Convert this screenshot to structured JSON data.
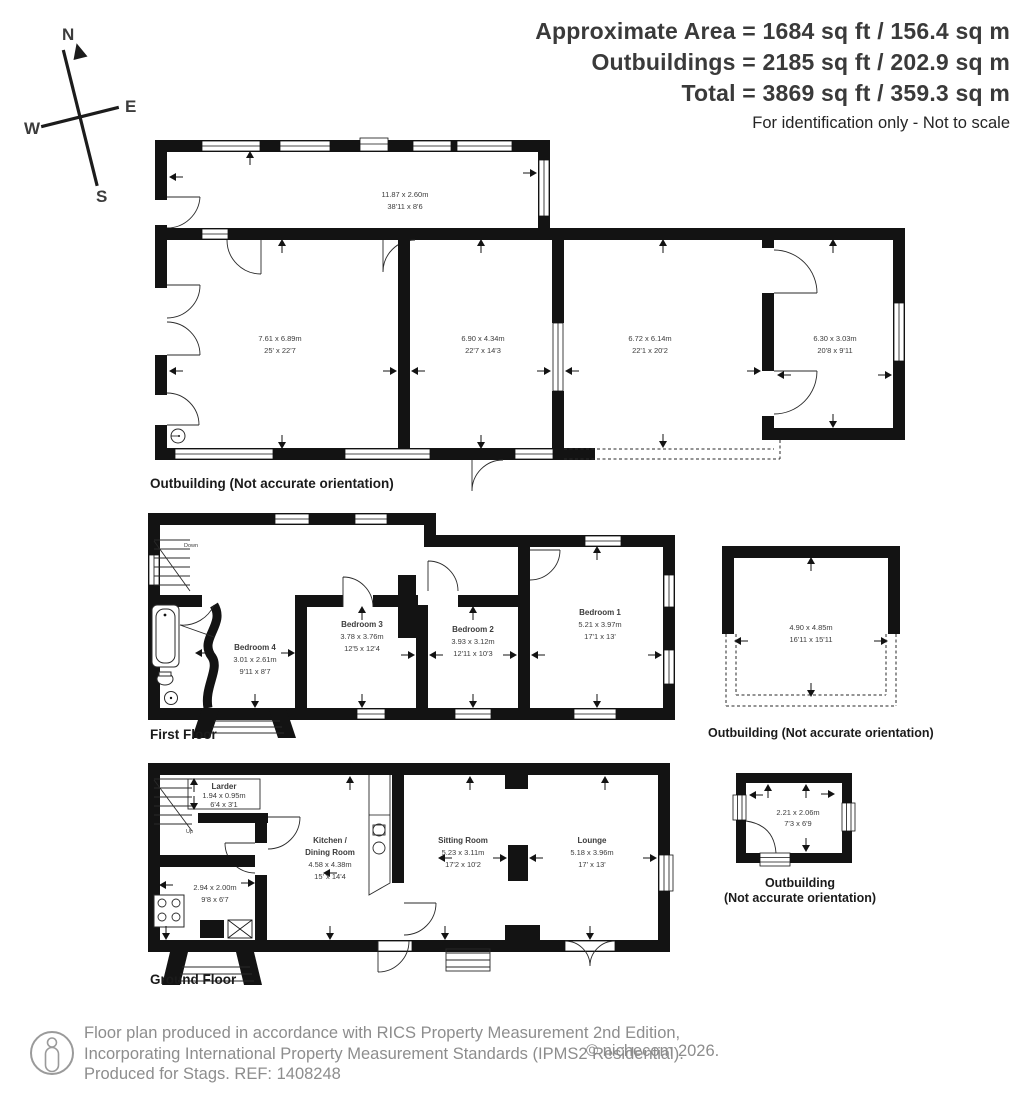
{
  "header": {
    "area_lines": [
      "Approximate Area = 1684 sq ft / 156.4 sq m",
      "Outbuildings = 2185 sq ft / 202.9 sq m",
      "Total = 3869 sq ft / 359.3 sq m"
    ],
    "note": "For identification only - Not to scale"
  },
  "compass": {
    "north": "N",
    "east": "E",
    "south": "S",
    "west": "W"
  },
  "plans": {
    "outbuilding_top": {
      "caption": "Outbuilding (Not accurate orientation)",
      "rooms": [
        {
          "dims_m": "11.87 x 2.60m",
          "dims_ft": "38'11 x 8'6"
        },
        {
          "dims_m": "7.61 x 6.89m",
          "dims_ft": "25' x 22'7"
        },
        {
          "dims_m": "6.90 x 4.34m",
          "dims_ft": "22'7 x 14'3"
        },
        {
          "dims_m": "6.72 x 6.14m",
          "dims_ft": "22'1 x 20'2"
        },
        {
          "dims_m": "6.30 x 3.03m",
          "dims_ft": "20'8 x 9'11"
        }
      ]
    },
    "first_floor": {
      "caption": "First Floor",
      "stairs_label": "Down",
      "rooms": [
        {
          "name": "Bedroom 4",
          "dims_m": "3.01 x 2.61m",
          "dims_ft": "9'11 x 8'7"
        },
        {
          "name": "Bedroom 3",
          "dims_m": "3.78 x 3.76m",
          "dims_ft": "12'5 x 12'4"
        },
        {
          "name": "Bedroom 2",
          "dims_m": "3.93 x 3.12m",
          "dims_ft": "12'11 x 10'3"
        },
        {
          "name": "Bedroom 1",
          "dims_m": "5.21 x 3.97m",
          "dims_ft": "17'1 x 13'"
        }
      ]
    },
    "outbuilding_mid": {
      "caption": "Outbuilding (Not accurate orientation)",
      "room": {
        "dims_m": "4.90 x 4.85m",
        "dims_ft": "16'11 x 15'11"
      }
    },
    "ground_floor": {
      "caption": "Ground Floor",
      "stairs_label": "Up",
      "rooms": [
        {
          "name": "Larder",
          "dims_m": "1.94 x 0.95m",
          "dims_ft": "6'4 x 3'1"
        },
        {
          "name_line1": "Kitchen /",
          "name_line2": "Dining Room",
          "dims_m": "4.58 x 4.38m",
          "dims_ft": "15' x 14'4"
        },
        {
          "dims_m": "2.94 x 2.00m",
          "dims_ft": "9'8 x 6'7"
        },
        {
          "name": "Sitting Room",
          "dims_m": "5.23 x 3.11m",
          "dims_ft": "17'2 x 10'2"
        },
        {
          "name": "Lounge",
          "dims_m": "5.18 x 3.96m",
          "dims_ft": "17' x 13'"
        }
      ]
    },
    "outbuilding_small": {
      "caption_line1": "Outbuilding",
      "caption_line2": "(Not accurate orientation)",
      "room": {
        "dims_m": "2.21 x 2.06m",
        "dims_ft": "7'3 x 6'9"
      }
    }
  },
  "footer": {
    "line1": "Floor plan produced in accordance with RICS Property Measurement 2nd Edition,",
    "line2": "Incorporating International Property Measurement Standards (IPMS2 Residential).",
    "line3": "Produced for Stags.   REF: 1408248",
    "copyright": "© nichecom 2026."
  },
  "colors": {
    "wall": "#131313",
    "header_text": "#3a3a3a",
    "footer_gray": "#8d8d8d"
  }
}
